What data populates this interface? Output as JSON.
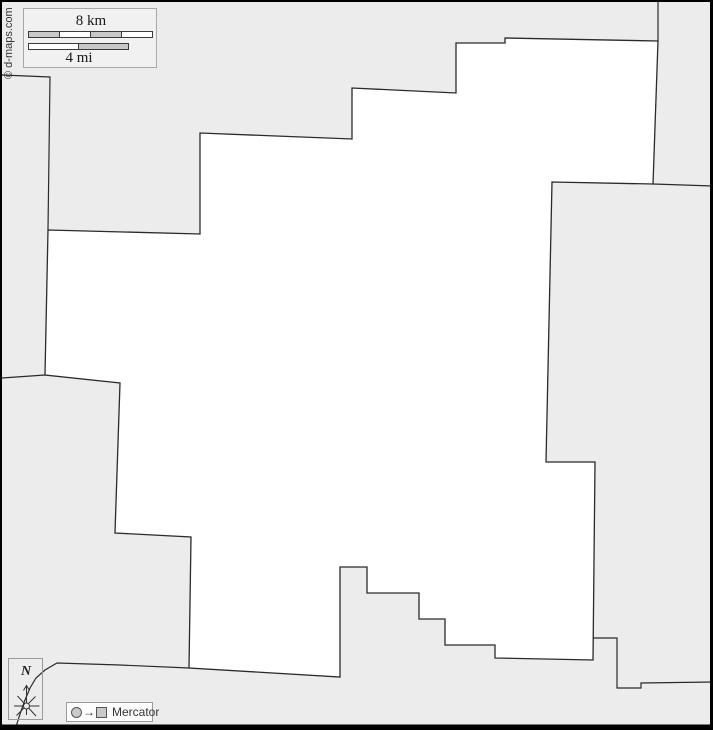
{
  "canvas": {
    "width": 713,
    "height": 730,
    "frame": {
      "top": 2,
      "left": 2,
      "right": 3,
      "bottom": 5.5
    }
  },
  "colors": {
    "background": "#ececec",
    "region_fill": "#ffffff",
    "border": "#2a2a2a",
    "frame": "#000000",
    "bar_gray": "#c9c9c9",
    "bar_white": "#ffffff",
    "bar_stroke": "#3a3a3a",
    "compass_stroke": "#333333"
  },
  "map": {
    "region_outline": [
      [
        48,
        230
      ],
      [
        200,
        234
      ],
      [
        200,
        133
      ],
      [
        352,
        139
      ],
      [
        352,
        88
      ],
      [
        456,
        93
      ],
      [
        456,
        43
      ],
      [
        505,
        43
      ],
      [
        505,
        38
      ],
      [
        658,
        41
      ],
      [
        653,
        184
      ],
      [
        552,
        182
      ],
      [
        546,
        462
      ],
      [
        595,
        462
      ],
      [
        593,
        660
      ],
      [
        495,
        658
      ],
      [
        495,
        645
      ],
      [
        445,
        645
      ],
      [
        445,
        619
      ],
      [
        419,
        619
      ],
      [
        419,
        593
      ],
      [
        367,
        593
      ],
      [
        367,
        567
      ],
      [
        340,
        567
      ],
      [
        340,
        677
      ],
      [
        189,
        668
      ],
      [
        191,
        537
      ],
      [
        115,
        533
      ],
      [
        120,
        383
      ],
      [
        45,
        375
      ]
    ],
    "neighbor_borders": [
      [
        [
          2,
          75
        ],
        [
          50,
          77
        ],
        [
          48,
          230
        ]
      ],
      [
        [
          2,
          378
        ],
        [
          45,
          375
        ]
      ],
      [
        [
          658,
          2
        ],
        [
          658,
          41
        ]
      ],
      [
        [
          653,
          184
        ],
        [
          713,
          186
        ]
      ],
      [
        [
          593,
          638
        ],
        [
          617,
          638
        ],
        [
          617,
          688
        ],
        [
          641,
          688
        ],
        [
          641,
          683
        ],
        [
          713,
          682
        ]
      ],
      [
        [
          189,
          668
        ],
        [
          120,
          665
        ],
        [
          57,
          663
        ],
        [
          45,
          670
        ],
        [
          36,
          678
        ],
        [
          30,
          688
        ],
        [
          25,
          700
        ],
        [
          20,
          714
        ],
        [
          15,
          730
        ]
      ]
    ]
  },
  "scale": {
    "km_label": "8 km",
    "mi_label": "4 mi",
    "km_bar": {
      "x": 0.5,
      "y": 0.5,
      "width": 124,
      "height": 6,
      "segments": 4,
      "start": "gray"
    },
    "mi_bar": {
      "x": 0.5,
      "y": 12.5,
      "width": 100,
      "height": 6,
      "segments": 2,
      "start": "white"
    }
  },
  "copyright": {
    "text": "© d-maps.com"
  },
  "compass": {
    "letter": "N"
  },
  "projection": {
    "arrow_glyph": "→",
    "label": "Mercator"
  }
}
